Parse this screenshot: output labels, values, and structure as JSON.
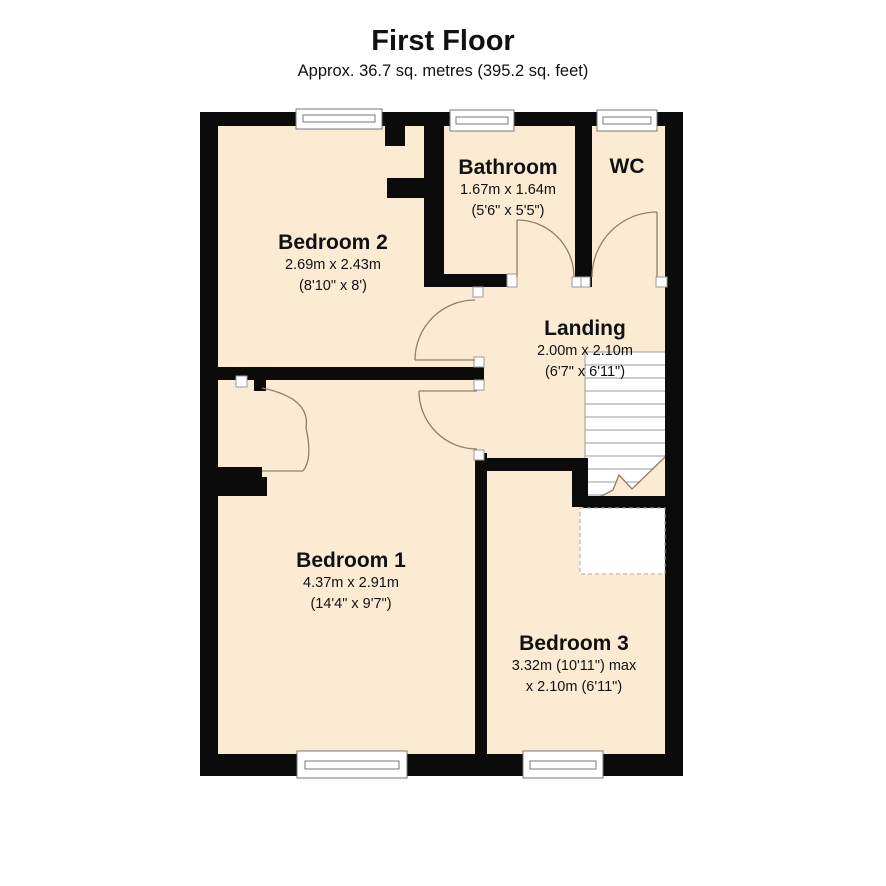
{
  "header": {
    "title": "First Floor",
    "subtitle": "Approx. 36.7 sq. metres (395.2 sq. feet)"
  },
  "rooms": [
    {
      "id": "bedroom2",
      "name": "Bedroom 2",
      "dim_line1": "2.69m x 2.43m",
      "dim_line2": "(8'10\" x 8')"
    },
    {
      "id": "bathroom",
      "name": "Bathroom",
      "dim_line1": "1.67m x 1.64m",
      "dim_line2": "(5'6\" x 5'5\")"
    },
    {
      "id": "wc",
      "name": "WC",
      "dim_line1": "",
      "dim_line2": ""
    },
    {
      "id": "landing",
      "name": "Landing",
      "dim_line1": "2.00m x 2.10m",
      "dim_line2": "(6'7\" x 6'11\")"
    },
    {
      "id": "bedroom1",
      "name": "Bedroom 1",
      "dim_line1": "4.37m x 2.91m",
      "dim_line2": "(14'4\" x 9'7\")"
    },
    {
      "id": "bedroom3",
      "name": "Bedroom 3",
      "dim_line1": "3.32m (10'11\") max",
      "dim_line2": "x 2.10m (6'11\")"
    }
  ],
  "colors": {
    "background": "#ffffff",
    "wall": "#0b0b0b",
    "floor": "#fbebd2",
    "door_arc": "#8e7f6a",
    "stair_tread": "#9a9a9a",
    "text": "#111111"
  }
}
